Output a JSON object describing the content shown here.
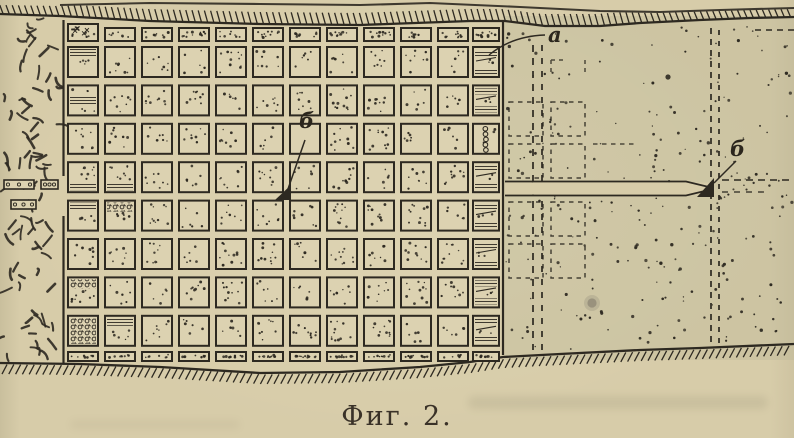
{
  "figure": {
    "caption": "Фиг. 2.",
    "labels": {
      "a": "а",
      "b_pillar": "б",
      "b_face": "б"
    },
    "colors": {
      "paper": "#d7cca9",
      "pillar_fill": "#dcd2b1",
      "ink": "#2d2921",
      "caption_text": "#3a3228",
      "right_area_tint": "#b9b594",
      "smudge_gray": "#7d7668"
    },
    "pillar_grid": {
      "full_columns": 11,
      "narrow_columns": 1,
      "full_rows": 8,
      "has_partial_top_row": true,
      "has_partial_bottom_row": true
    }
  }
}
